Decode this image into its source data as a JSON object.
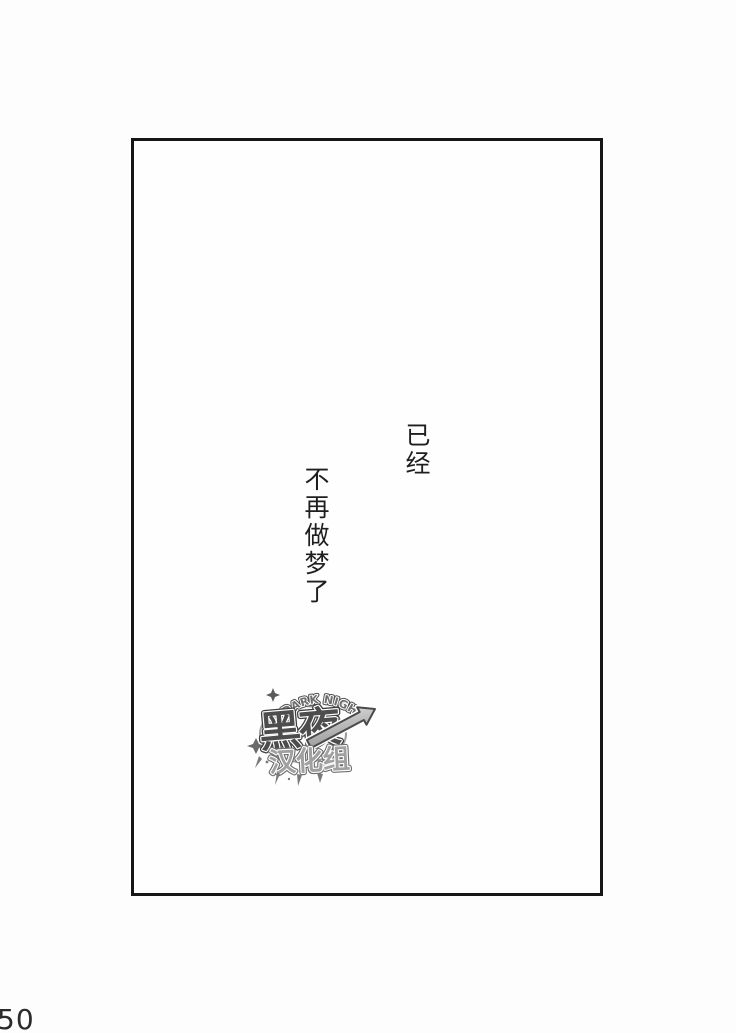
{
  "page": {
    "number": "50"
  },
  "panel": {
    "border_color": "#161616",
    "background": "#fefefe"
  },
  "dialogue": {
    "column1": "已经",
    "column2": "不再做梦了",
    "text_color": "#1f1f1f"
  },
  "watermark": {
    "arc_text": "DARK NIGHT",
    "title": "黑夜",
    "subtitle": "汉化组",
    "arrow_icon": "up-right-arrow",
    "colors": {
      "title_fill": "#4d4d4d",
      "subtitle_fill": "#a0a0a0",
      "arrow_light": "#e6e6e6",
      "arrow_dark": "#969696",
      "outline": "#3f3f3f"
    }
  }
}
